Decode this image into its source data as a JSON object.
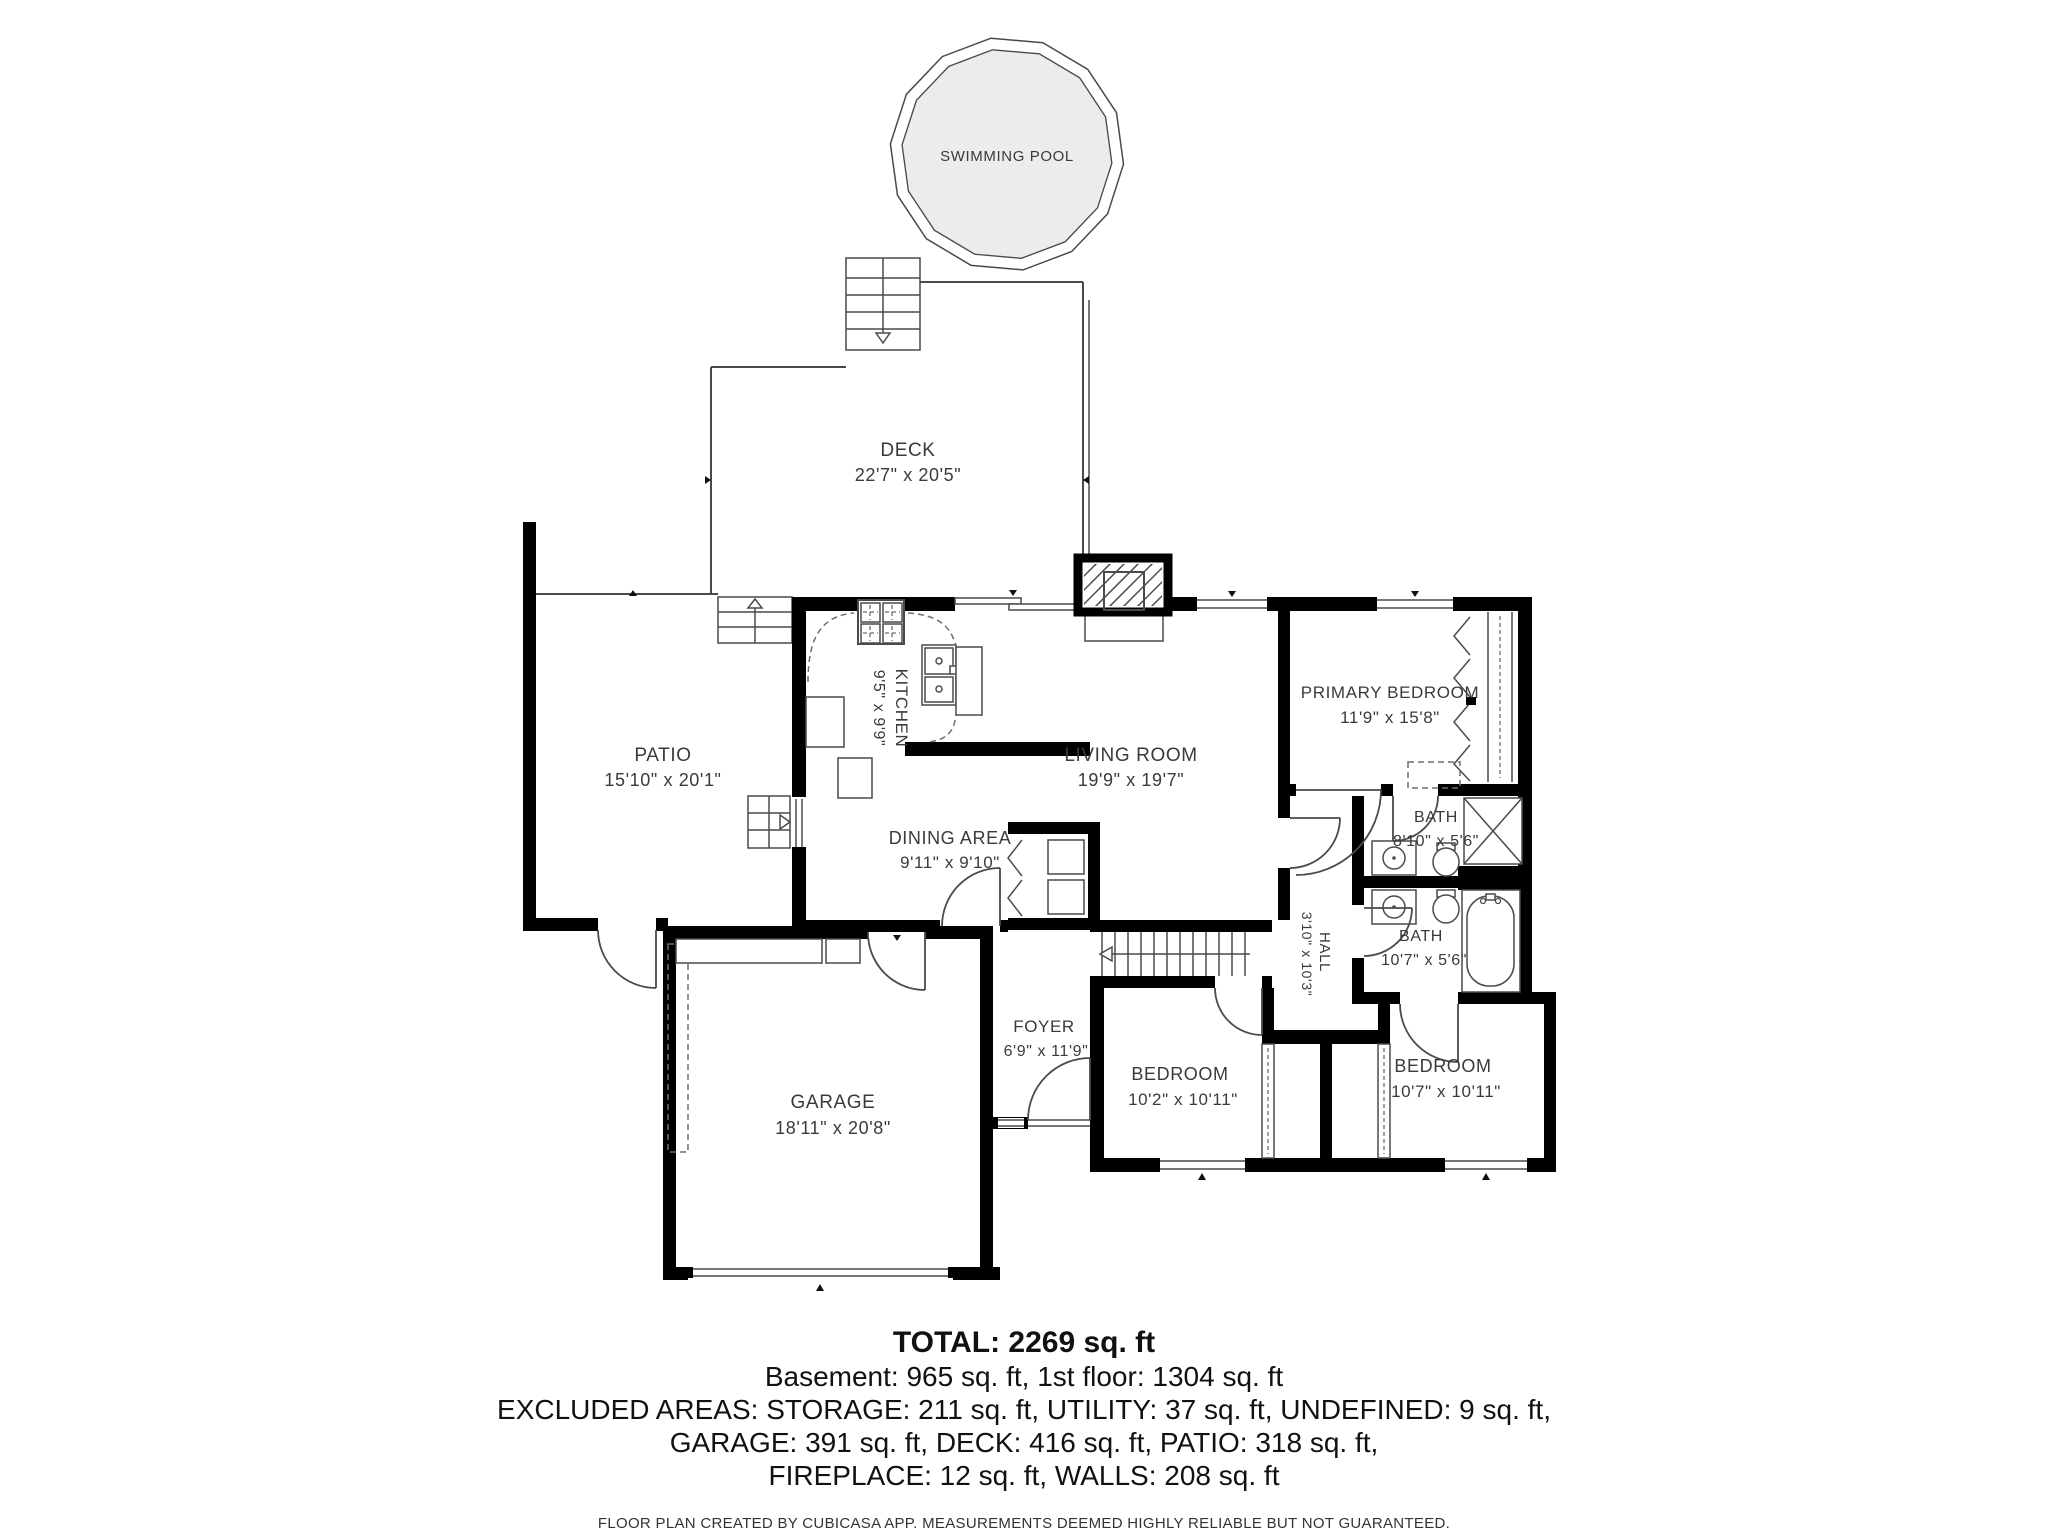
{
  "meta": {
    "background": "#ffffff",
    "wall_color": "#000000",
    "line_color": "#4a4a4a",
    "text_color": "#3a3a3a",
    "pool_fill": "#ececec"
  },
  "rooms": {
    "swimming_pool": {
      "name": "SWIMMING POOL"
    },
    "deck": {
      "name": "DECK",
      "dims": "22'7\" x 20'5\""
    },
    "patio": {
      "name": "PATIO",
      "dims": "15'10\" x 20'1\""
    },
    "kitchen": {
      "name": "KITCHEN",
      "dims": "9'5\" x 9'9\""
    },
    "living_room": {
      "name": "LIVING ROOM",
      "dims": "19'9\" x 19'7\""
    },
    "primary_bedroom": {
      "name": "PRIMARY BEDROOM",
      "dims": "11'9\" x 15'8\""
    },
    "dining_area": {
      "name": "DINING AREA",
      "dims": "9'11\" x 9'10\""
    },
    "bath_upper": {
      "name": "BATH",
      "dims": "8'10\" x 5'6\""
    },
    "bath_lower": {
      "name": "BATH",
      "dims": "10'7\" x 5'6\""
    },
    "hall": {
      "name": "HALL",
      "dims": "3'10\" x 10'3\""
    },
    "foyer": {
      "name": "FOYER",
      "dims": "6'9\" x 11'9\""
    },
    "bedroom_left": {
      "name": "BEDROOM",
      "dims": "10'2\" x 10'11\""
    },
    "bedroom_right": {
      "name": "BEDROOM",
      "dims": "10'7\" x 10'11\""
    },
    "garage": {
      "name": "GARAGE",
      "dims": "18'11\" x 20'8\""
    }
  },
  "summary": {
    "total": "TOTAL: 2269 sq. ft",
    "line1": "Basement: 965 sq. ft, 1st floor: 1304 sq. ft",
    "line2": "EXCLUDED AREAS: STORAGE: 211 sq. ft, UTILITY: 37 sq. ft, UNDEFINED: 9 sq. ft,",
    "line3": "GARAGE: 391 sq. ft, DECK: 416 sq. ft, PATIO: 318 sq. ft,",
    "line4": "FIREPLACE: 12 sq. ft, WALLS: 208 sq. ft"
  },
  "footer": {
    "disclaimer": "FLOOR PLAN CREATED BY CUBICASA APP. MEASUREMENTS DEEMED HIGHLY RELIABLE BUT NOT GUARANTEED."
  }
}
